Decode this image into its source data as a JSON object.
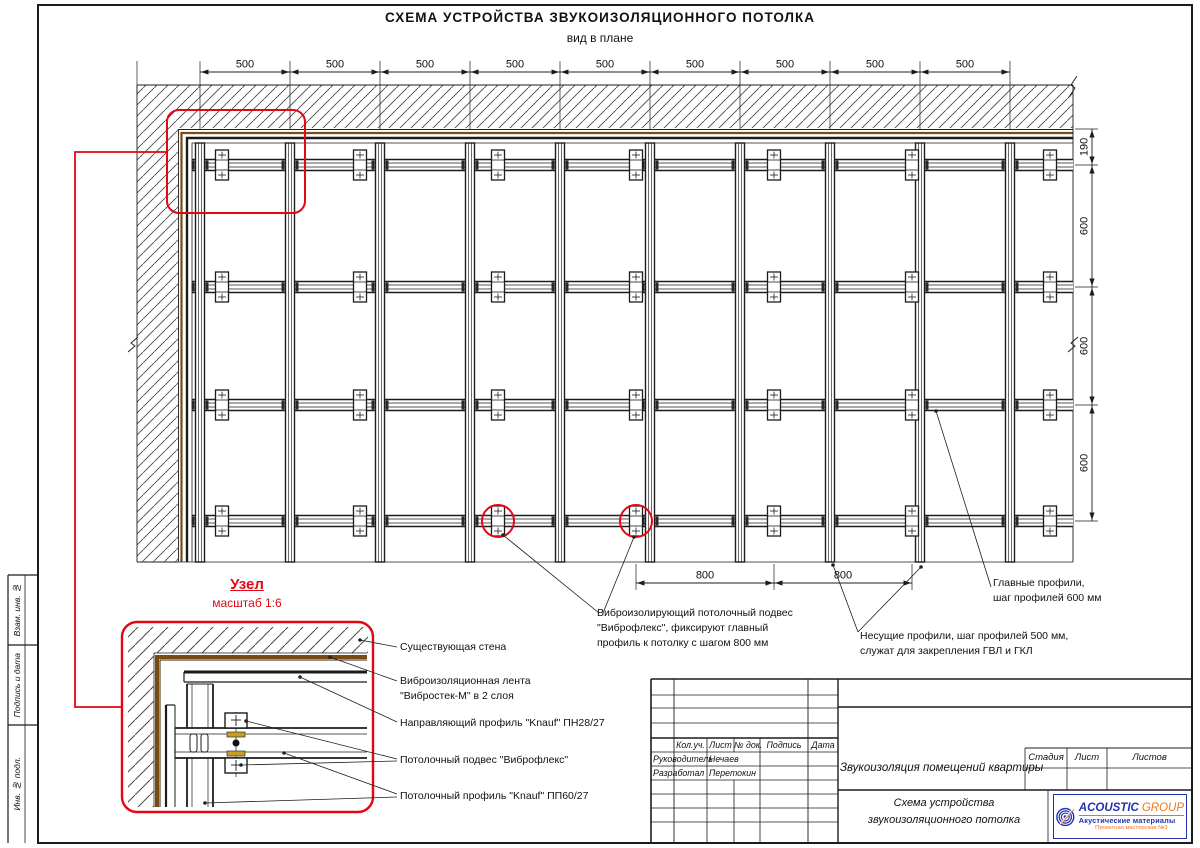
{
  "sheet": {
    "title": "СХЕМА УСТРОЙСТВА ЗВУКОИЗОЛЯЦИОННОГО ПОТОЛКА",
    "subtitle": "вид в плане"
  },
  "plan": {
    "top_dims": [
      "500",
      "500",
      "500",
      "500",
      "500",
      "500",
      "500",
      "500",
      "500"
    ],
    "right_dims": [
      "190",
      "600",
      "600",
      "600"
    ],
    "bottom_dims": [
      "800",
      "800"
    ]
  },
  "detail": {
    "title": "Узел",
    "scale": "масштаб 1:6",
    "callouts": [
      {
        "lines": [
          "Существующая стена"
        ]
      },
      {
        "lines": [
          "Виброизоляционная лента",
          "\"Вибростек-М\" в 2 слоя"
        ]
      },
      {
        "lines": [
          "Направляющий профиль \"Knauf\" ПН28/27"
        ]
      },
      {
        "lines": [
          "Потолочный подвес \"Виброфлекс\""
        ]
      },
      {
        "lines": [
          "Потолочный профиль \"Knauf\" ПП60/27"
        ]
      }
    ]
  },
  "annotations": {
    "hanger": {
      "lines": [
        "Виброизолирующий потолочный подвес",
        "\"Виброфлекс\", фиксируют главный",
        "профиль к потолку с шагом 800 мм"
      ]
    },
    "carrier": {
      "lines": [
        "Несущие профили, шаг профилей 500 мм,",
        "служат для закрепления ГВЛ и ГКЛ"
      ]
    },
    "main": {
      "lines": [
        "Главные профили,",
        "шаг профилей 600 мм"
      ]
    }
  },
  "titleblock": {
    "col_headers": {
      "kol": "Кол.уч.",
      "sheet": "Лист",
      "doc": "№ док.",
      "sign": "Подпись",
      "date": "Дата"
    },
    "roles": [
      {
        "role": "Руководитель",
        "name": "Нечаев"
      },
      {
        "role": "Разработал",
        "name": "Перетокин"
      }
    ],
    "project": "Звукоизоляция помещений квартиры",
    "stage": {
      "stage": "Стадия",
      "sheet": "Лист",
      "sheets": "Листов"
    },
    "doc_title": {
      "lines": [
        "Схема устройства",
        "звукоизоляционного потолка"
      ]
    }
  },
  "logo": {
    "brand1": "ACOUSTIC",
    "brand2": "GROUP",
    "tagline": "Акустические материалы",
    "sub": "Проектная мастерская №3"
  },
  "sidebar": {
    "labels": [
      "Взам. инв. №",
      "Подпись и дата",
      "Инв. № подл."
    ]
  },
  "colors": {
    "line": "#1c1c1c",
    "accent_red": "#e30613",
    "tape_brown": "#7a4a15",
    "pad_yellow": "#c8a020",
    "logo_blue": "#2133b0",
    "logo_orange": "#f47216"
  }
}
